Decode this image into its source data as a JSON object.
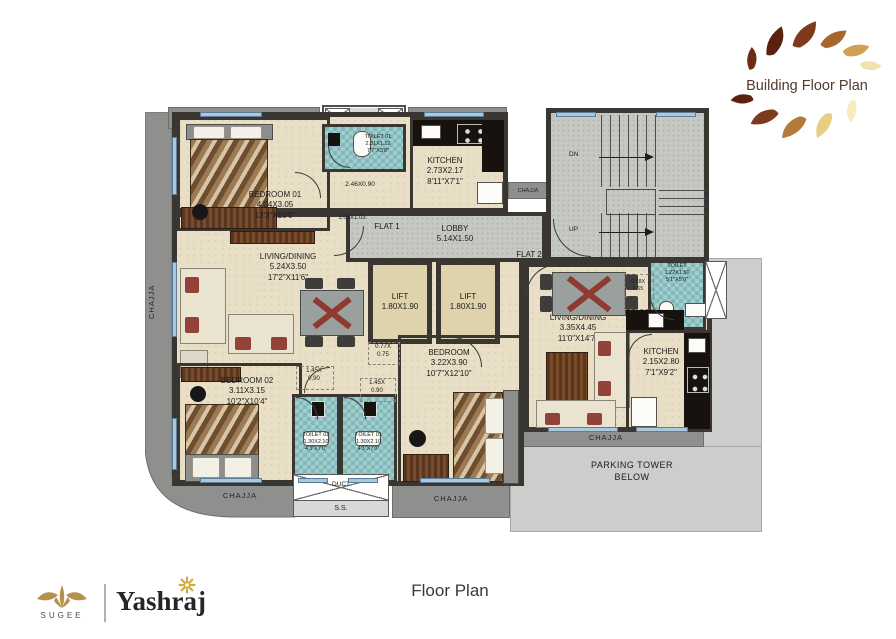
{
  "header": {
    "logo_title": "Building Floor Plan"
  },
  "footer": {
    "caption": "Floor Plan",
    "sugee": "SUGEE",
    "yashraj": "Yashraj"
  },
  "labels": {
    "chajja": "CHAJJA",
    "ss": "S.S.",
    "duct": "DUCT",
    "flat1": "FLAT 1",
    "flat2": "FLAT 2",
    "dn": "DN",
    "up": "UP",
    "parking1": "PARKING TOWER",
    "parking2": "BELOW"
  },
  "rooms": {
    "bedroom01": {
      "name": "BEDROOM 01",
      "m": "4.04X3.05",
      "ft": "13'3\"X10'0\""
    },
    "toilet01_top": {
      "name": "TOILET 01",
      "m": "2.31X1.12",
      "ft": "7'7\"X3'8\""
    },
    "kitchen_f1": {
      "name": "KITCHEN",
      "m": "2.73X2.17",
      "ft": "8'11\"X7'1\""
    },
    "living_f1": {
      "name": "LIVING/DINING",
      "m": "5.24X3.50",
      "ft": "17'2\"X11'6\""
    },
    "bedroom02": {
      "name": "BEDROOM 02",
      "m": "3.11X3.15",
      "ft": "10'2\"X10'4\""
    },
    "toilet02_bottom": {
      "name": "TOILET 02",
      "m": "1.30X2.10",
      "ft": "4'3\"X7'0\""
    },
    "toilet01_bottom": {
      "name": "TOILET 01",
      "m": "1.30X2.10",
      "ft": "4'3\"X7'0\""
    },
    "bedroom_f2": {
      "name": "BEDROOM",
      "m": "3.22X3.90",
      "ft": "10'7\"X12'10\""
    },
    "living_f2": {
      "name": "LIVING/DINING",
      "m": "3.35X4.45",
      "ft": "11'0\"X14'7\""
    },
    "toilet_f2": {
      "name": "TOILET",
      "m": "1.22X1.50",
      "ft": "5'1\"X5'0\""
    },
    "kitchen_f2": {
      "name": "KITCHEN",
      "m": "2.15X2.80",
      "ft": "7'1\"X9'2\""
    },
    "lift1": {
      "name": "LIFT",
      "m": "1.80X1.90"
    },
    "lift2": {
      "name": "LIFT",
      "m": "1.80X1.90"
    },
    "lobby": {
      "name": "LOBBY",
      "m": "5.14X1.50"
    }
  },
  "dims": {
    "passage_246": "2.46X0.90",
    "passage_105": "1.05X1.03",
    "p145a_1": "1.45X",
    "p145a_2": "0.90",
    "p145b_1": "1.45X",
    "p145b_2": "0.90",
    "p077_1": "0.77X",
    "p077_2": "0.75",
    "p078_1": "0.78X",
    "p078_2": "1.65"
  },
  "colors": {
    "floor_beige": "#e9dfc6",
    "wall": "#3a3733",
    "chajja_gray": "#8f8f8d",
    "stair_gray": "#c6c9c3",
    "toilet_teal": "#7fb9ba",
    "parking_gray": "#cdcdcb",
    "logo_gold": "#b5924c",
    "logo_brown": "#53392b",
    "cushion_red": "#93423a"
  }
}
